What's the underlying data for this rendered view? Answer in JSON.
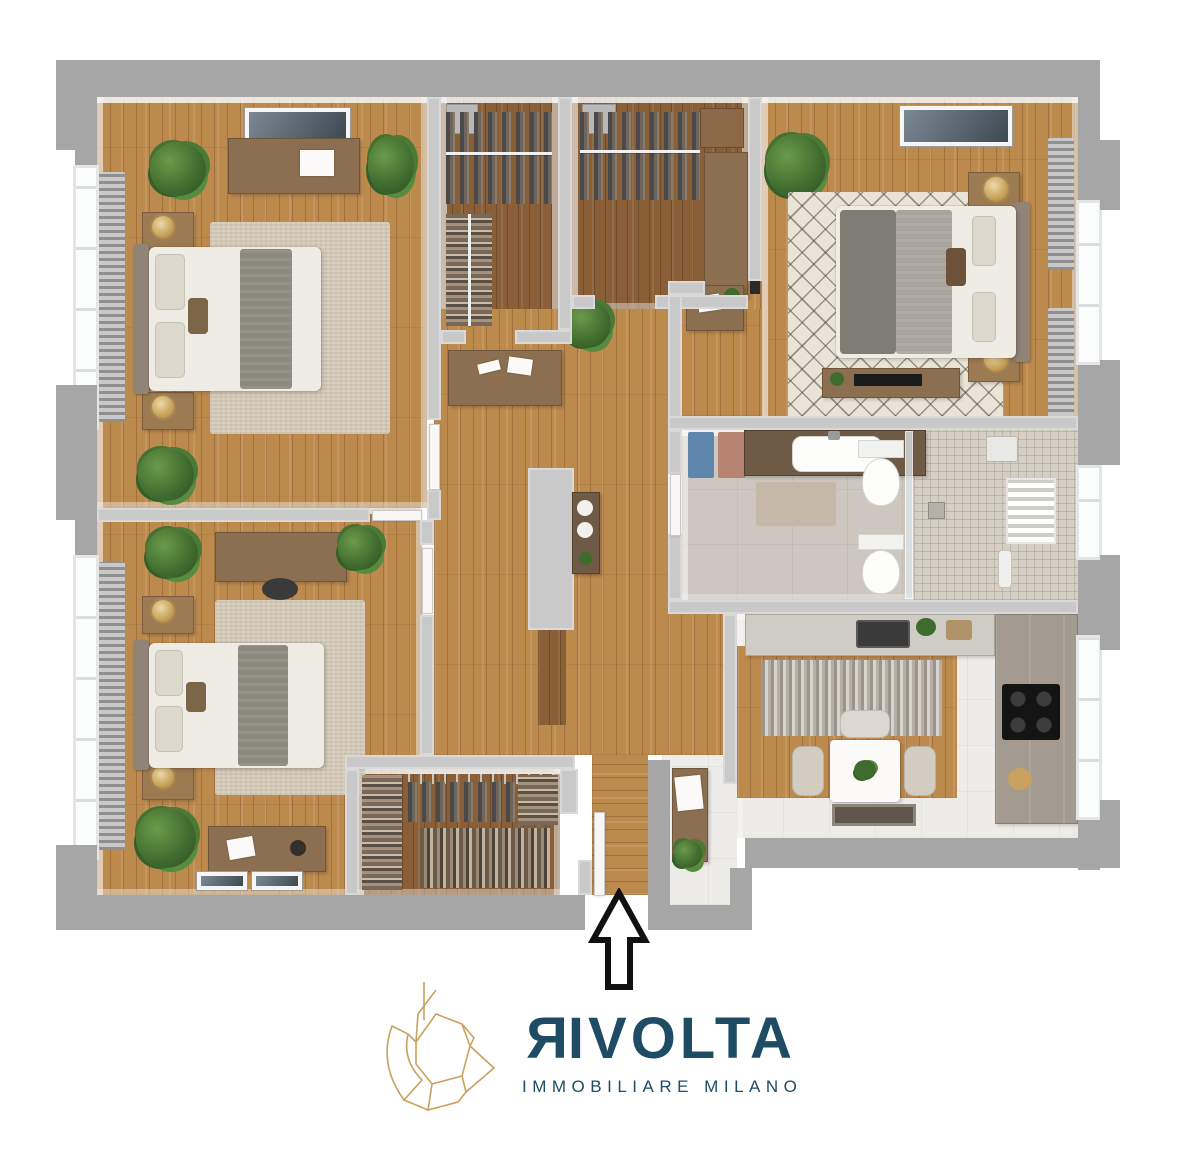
{
  "brand": {
    "name": "RIVOLTA",
    "name_initial": "R",
    "name_rest": "IVOLTA",
    "tagline": "IMMOBILIARE MILANO"
  },
  "entry": {
    "arrow_direction": "up"
  },
  "palette": {
    "logo_navy": "#1e4c64",
    "logo_gold": "#c9a15e",
    "background": "#ffffff",
    "outer_wall": "#a6a6a6",
    "inner_wall": "#c9c9c9",
    "wood_floor": "#bd8a4e",
    "closet_wood_floor": "#8a5f38",
    "bathroom_floor": "#cdc7c0",
    "kitchen_floor": "#edece8",
    "rug_beige": "#d9d0bf",
    "plant_green": "#3f6b2f",
    "arrow_black": "#111111"
  }
}
